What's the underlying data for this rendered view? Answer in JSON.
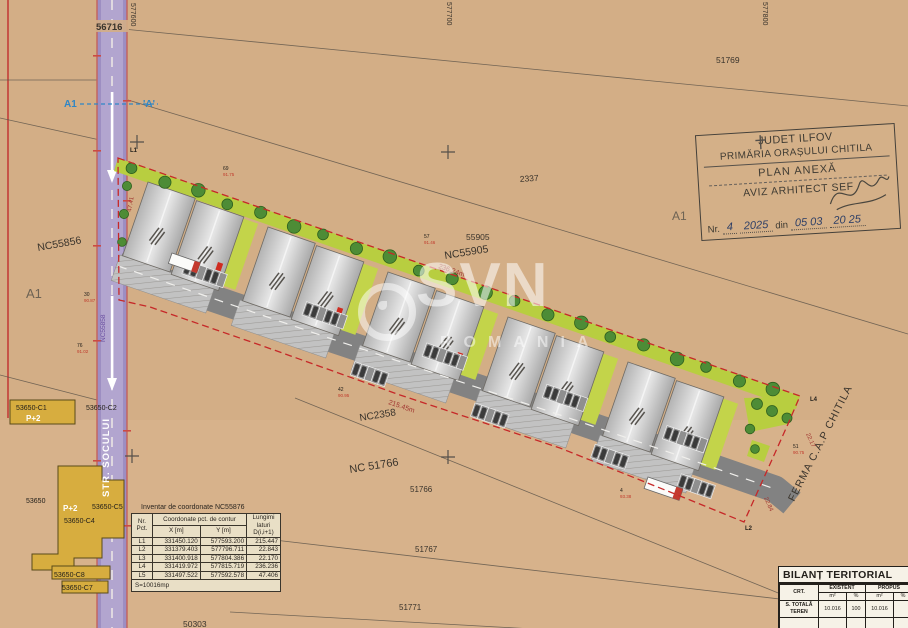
{
  "parcels": {
    "p56716": "56716",
    "g577600": "577600",
    "g577700": "577700",
    "g577800": "577800",
    "p51769": "51769",
    "p2337": "2337",
    "a1_field": "A1",
    "a1_west": "A1",
    "p55905": "55905",
    "nc55905": "NC55905",
    "nc55856": "NC55856",
    "nc2358": "NC2358",
    "nc51766": "NC 51766",
    "p51766": "51766",
    "p51767": "51767",
    "p51771": "51771",
    "p50303": "50303",
    "ferma": "FERMA C.A.P CHITILA"
  },
  "street": {
    "name": "STR. SOCULUI",
    "code": "NC55858",
    "marker_left": "A1",
    "marker_right": "'A'"
  },
  "dims": {
    "top": "236.24m",
    "road": "215.45m",
    "edge1": "22.17",
    "edge2": "22.84",
    "edge_street": "47.41"
  },
  "boundary_points": {
    "l1": "L1",
    "l2": "L2",
    "l4": "L4"
  },
  "survey_points": [
    {
      "n": "69",
      "e": "91.75"
    },
    {
      "n": "30",
      "e": "90.87"
    },
    {
      "n": "76",
      "e": "91.02"
    },
    {
      "n": "42",
      "e": "90.95"
    },
    {
      "n": "57",
      "e": "91.46"
    },
    {
      "n": "4",
      "e": "93.38"
    },
    {
      "n": "51",
      "e": "90.75"
    }
  ],
  "existing_buildings": {
    "c1": "53650-C1",
    "c1_h": "P+2",
    "c2": "53650-C2",
    "main": "53650",
    "main_h": "P+2",
    "c5": "53650-C5",
    "c4": "53650-C4",
    "c8": "53650-C8",
    "c7": "53650-C7"
  },
  "stamp": {
    "line1": "JUDET ILFOV",
    "line2": "PRIMĂRIA ORAȘULUI CHITILA",
    "line3": "PLAN ANEXĂ",
    "line4": "AVIZ ARHITECT SEF",
    "nr_label": "Nr.",
    "nr_value": "4",
    "nr_value2": "2025",
    "din_label": "din",
    "date_value": "05 03",
    "date_value2": "20 25"
  },
  "coord_table": {
    "title": "Inventar de coordonate NC55876",
    "headers": {
      "nr": "Nr. Pct.",
      "coord": "Coordonate pct. de contur",
      "x": "X [m]",
      "y": "Y [m]",
      "len": "Lungimi laturi D(i,i+1)"
    },
    "rows": [
      [
        "L1",
        "331450.120",
        "577593.200",
        "215.447"
      ],
      [
        "L2",
        "331379.403",
        "577796.711",
        "22.843"
      ],
      [
        "L3",
        "331400.918",
        "577804.386",
        "22.170"
      ],
      [
        "L4",
        "331419.972",
        "577815.719",
        "236.236"
      ],
      [
        "L5",
        "331497.522",
        "577592.578",
        "47.406"
      ]
    ],
    "area": "S=10016mp"
  },
  "bilant": {
    "title": "BILANȚ TERITORIAL",
    "col_crt": "CRT.",
    "col_existent": "EXISTENT",
    "col_propus": "PROPUS",
    "unit_m2": "m²",
    "unit_pct": "%",
    "row_label": "S. TOTALĂ TEREN",
    "existent_m2": "10.016",
    "existent_pct": "100",
    "propus_m2": "10.016"
  },
  "watermark": {
    "brand": "SVN",
    "country": "ROMANIA"
  }
}
